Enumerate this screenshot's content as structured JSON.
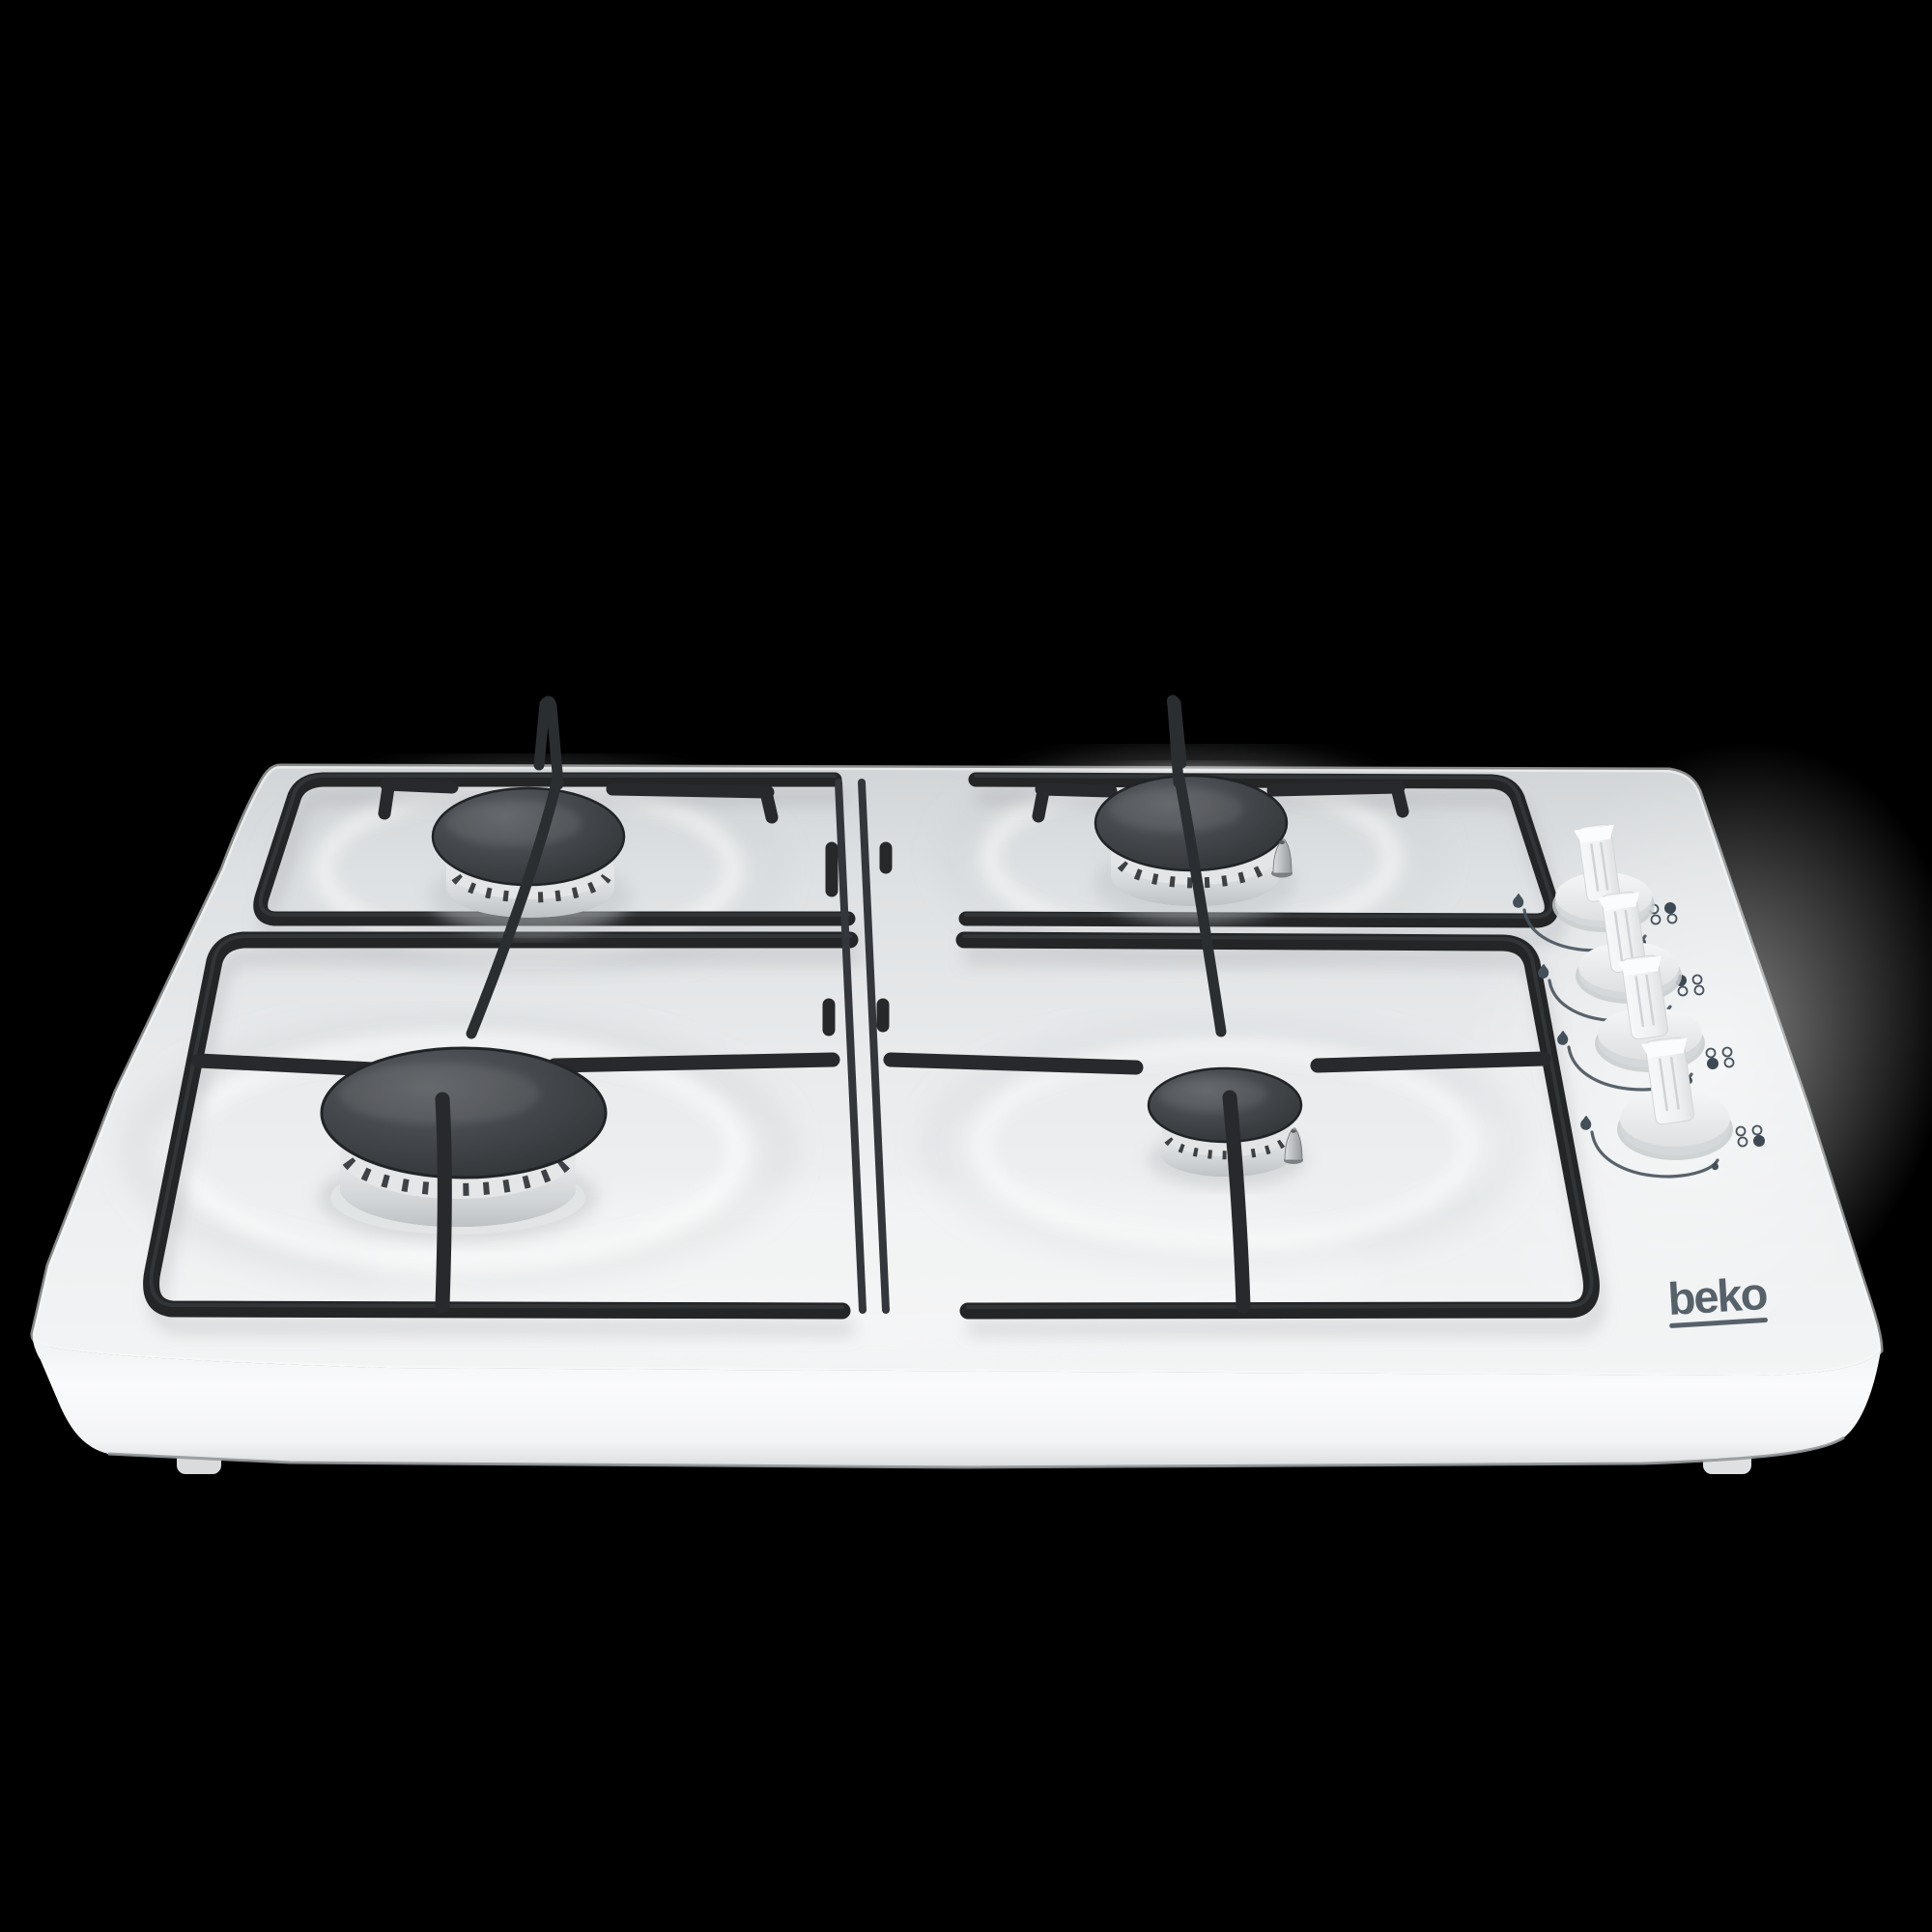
{
  "background_color": "#000000",
  "brand": {
    "logo_text": "beko",
    "logo_color": "#57616a"
  },
  "indicator": {
    "filled_color": "#3d4953",
    "outline_color": "#46525c"
  },
  "hob": {
    "body_color": "#eef0f2",
    "grate_color": "#232527",
    "burner_count": 4
  },
  "burners": [
    {
      "id": "burner-rear-left",
      "position": "rear-left",
      "size": "medium"
    },
    {
      "id": "burner-rear-right",
      "position": "rear-right",
      "size": "medium",
      "ignition_plug_visible": true
    },
    {
      "id": "burner-front-left",
      "position": "front-left",
      "size": "large"
    },
    {
      "id": "burner-front-right",
      "position": "front-right",
      "size": "small",
      "ignition_plug_visible": true
    }
  ],
  "knobs": [
    {
      "id": "knob-1",
      "controls_burner": "rear-right",
      "filled_dot": "top-right",
      "max_icon": "flame-large-icon",
      "min_icon": "flame-small-icon"
    },
    {
      "id": "knob-2",
      "controls_burner": "rear-left",
      "filled_dot": "top-left",
      "max_icon": "flame-large-icon",
      "min_icon": "flame-small-icon"
    },
    {
      "id": "knob-3",
      "controls_burner": "front-left",
      "filled_dot": "bottom-left",
      "max_icon": "flame-large-icon",
      "min_icon": "flame-small-icon"
    },
    {
      "id": "knob-4",
      "controls_burner": "front-right",
      "filled_dot": "bottom-right",
      "max_icon": "flame-large-icon",
      "min_icon": "flame-small-icon"
    }
  ]
}
